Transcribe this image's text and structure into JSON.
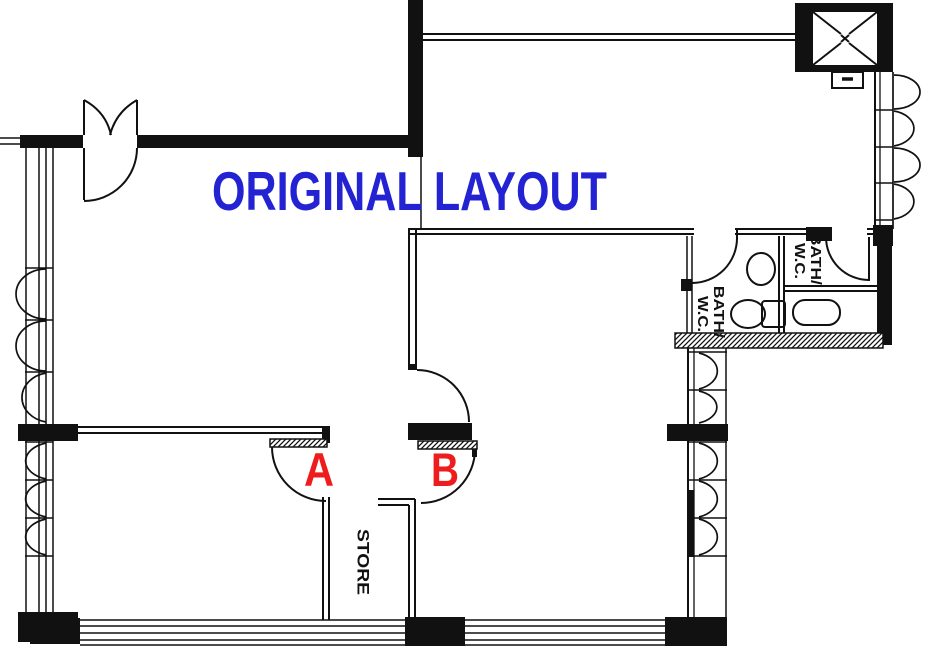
{
  "title": {
    "text": "ORIGINAL LAYOUT",
    "color": "#2323D3"
  },
  "doors": {
    "a_label": "A",
    "b_label": "B",
    "label_color": "#EE1C1C"
  },
  "rooms": {
    "store": {
      "label": "STORE"
    },
    "bath_left": {
      "line1": "BATH/",
      "line2": "W.C."
    },
    "bath_right": {
      "line1": "BATH/",
      "line2": "W.C."
    }
  },
  "drawing": {
    "line_color": "#111111",
    "background": "#FFFFFF"
  }
}
